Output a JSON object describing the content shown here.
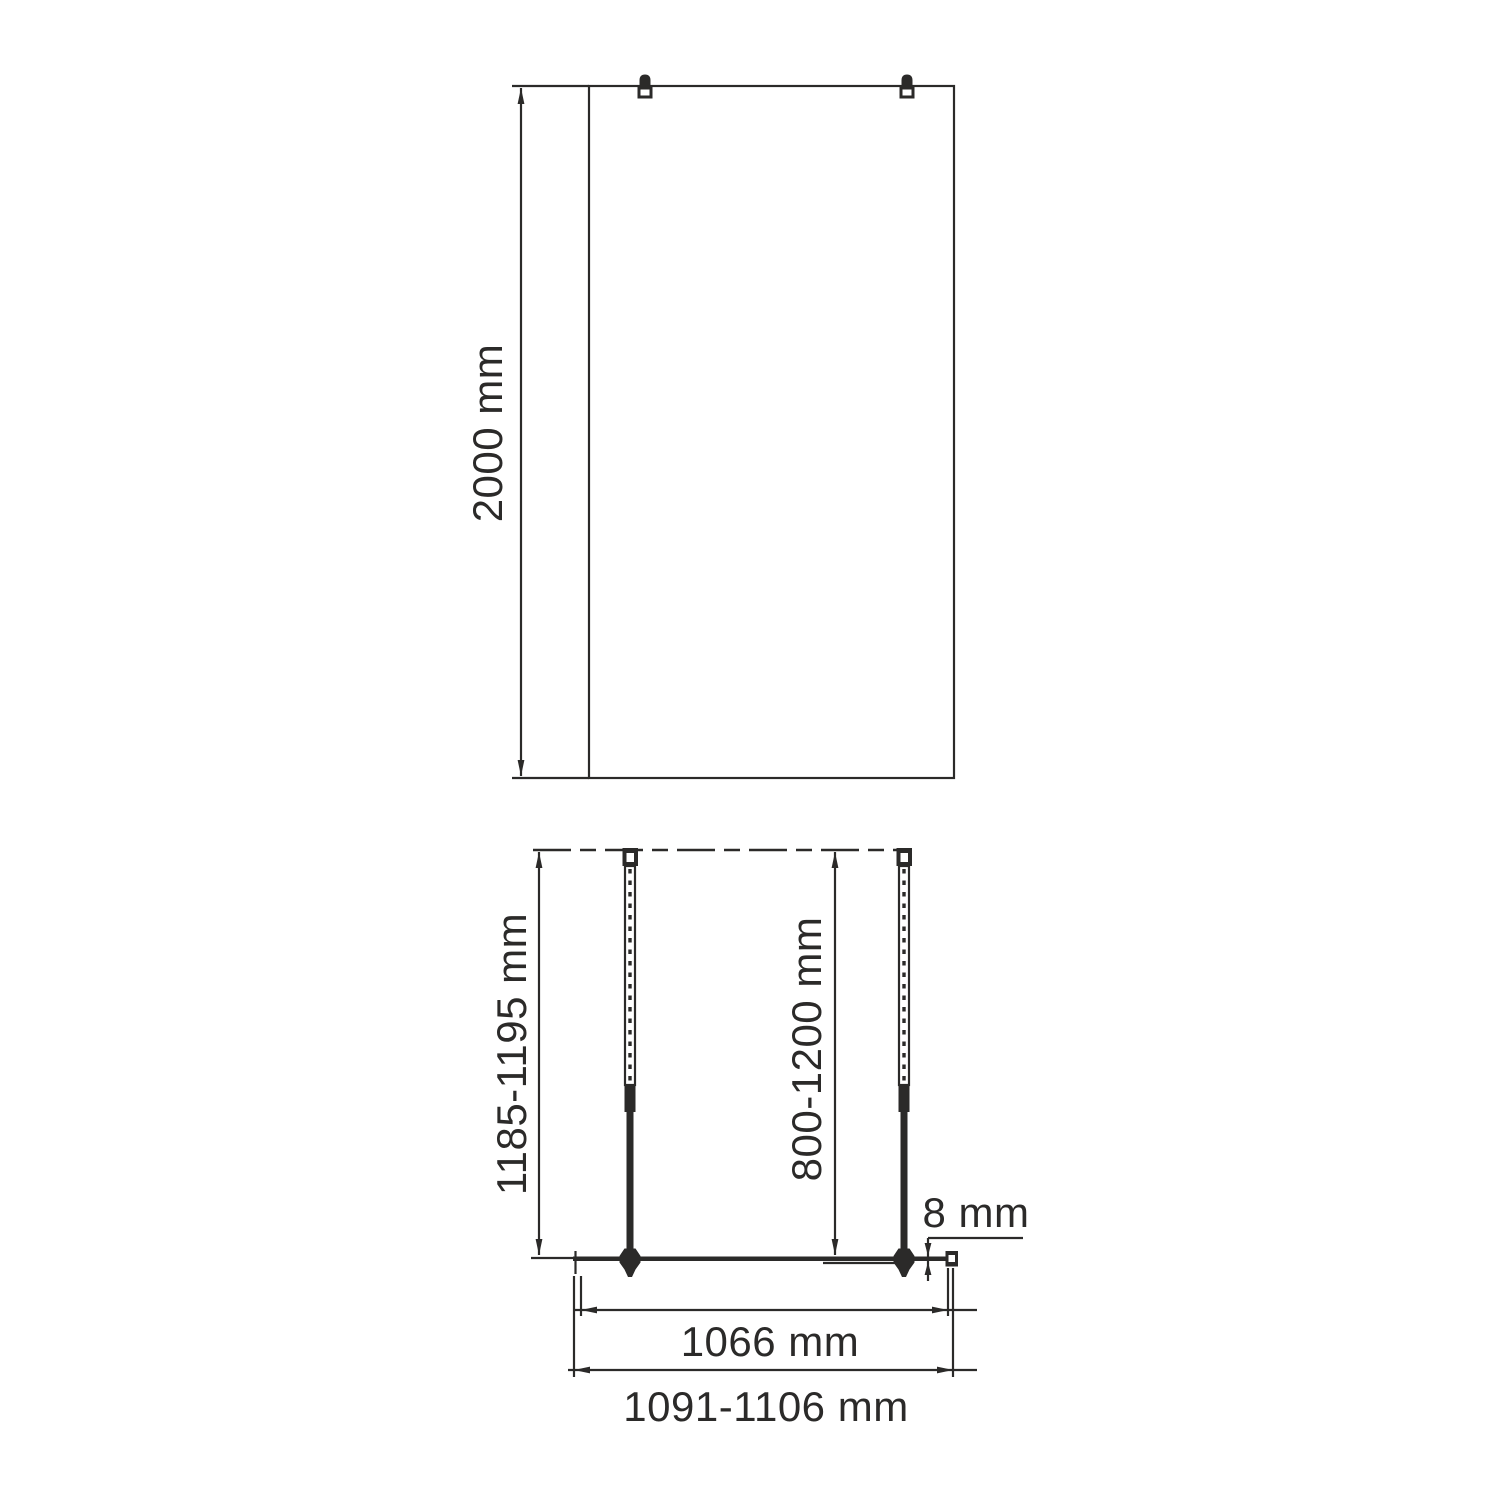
{
  "colors": {
    "line": "#2b2a29",
    "background": "#ffffff"
  },
  "front_view": {
    "height": {
      "label": "2000 mm"
    }
  },
  "plan_view": {
    "wall_offset": {
      "label": "1185-1195 mm"
    },
    "bar_length": {
      "label": "800-1200 mm"
    },
    "glass_thickness": {
      "label": "8 mm"
    },
    "glass_width": {
      "label": "1066 mm"
    },
    "overall_width": {
      "label": "1091-1106 mm"
    }
  }
}
